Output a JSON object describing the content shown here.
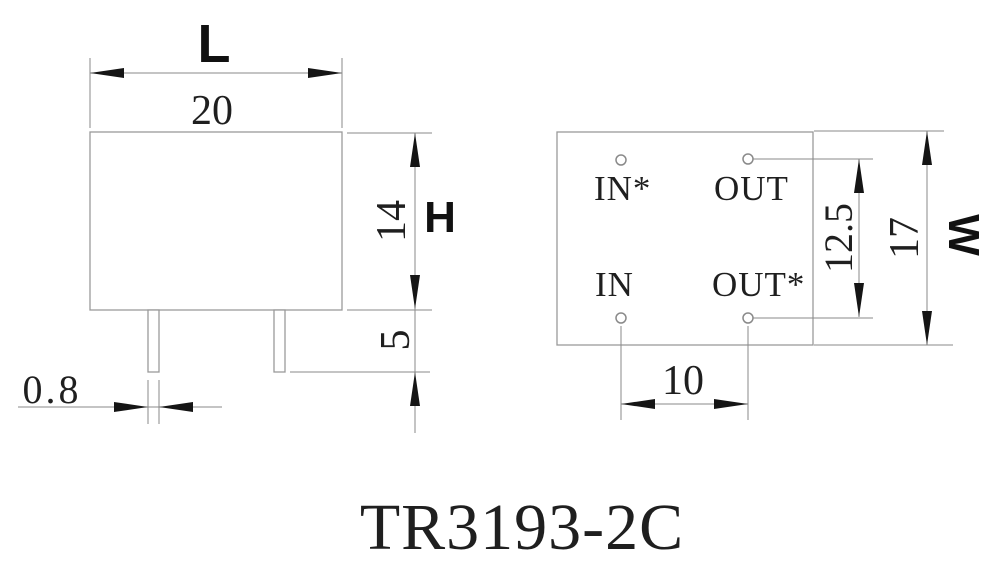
{
  "title": "TR3193-2C",
  "front_view": {
    "length_label": "L",
    "length_value": "20",
    "height_label": "H",
    "height_value": "14",
    "pin_length_value": "5",
    "pin_width_value": "0.8"
  },
  "bottom_view": {
    "pin_top_left": "IN*",
    "pin_top_right": "OUT",
    "pin_bottom_left": "IN",
    "pin_bottom_right": "OUT*",
    "row_pitch_value": "12.5",
    "width_label": "W",
    "width_value": "17",
    "column_pitch_value": "10"
  },
  "colors": {
    "background": "#ffffff",
    "body_outline": "#9a9a9a",
    "dimension_line": "#8a8a8a",
    "arrow_fill": "#151515",
    "text": "#1f1f1f"
  }
}
